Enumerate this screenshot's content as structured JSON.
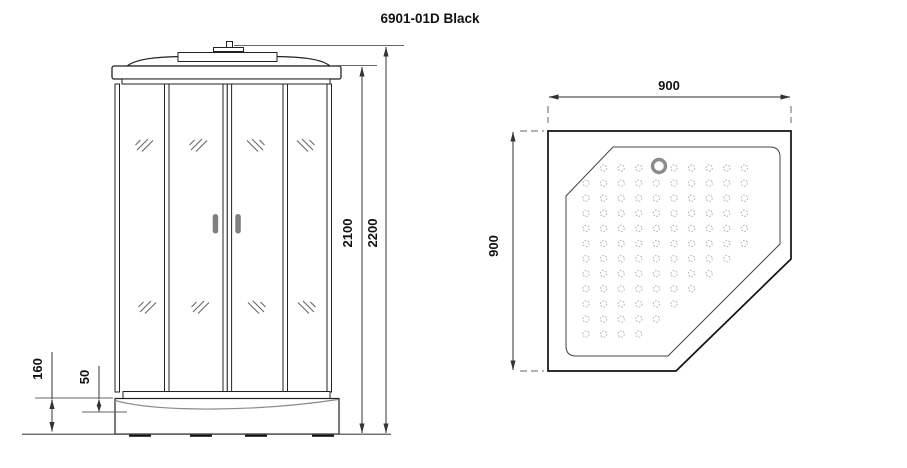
{
  "title": "6901-01D Black",
  "front_view": {
    "label_total_height": "2200",
    "label_cabin_height": "2100",
    "label_tray_height": "160",
    "label_tray_depth": "50"
  },
  "top_view": {
    "label_width": "900",
    "label_depth": "900"
  },
  "colors": {
    "line": "#222222",
    "dimension": "#555555",
    "handle": "#7f7f7f",
    "drain_ring": "#8c8c8c",
    "dot": "#b8b8b8"
  },
  "pattern": {
    "cols": 10,
    "rows": 12,
    "x0": 586,
    "y0": 168,
    "dx": 17.6,
    "dy": 15.1,
    "r": 3.1,
    "drain": {
      "cx": 659,
      "cy": 166,
      "r": 6.5
    },
    "clip_sum_max": 988,
    "diag_margin": 340
  }
}
